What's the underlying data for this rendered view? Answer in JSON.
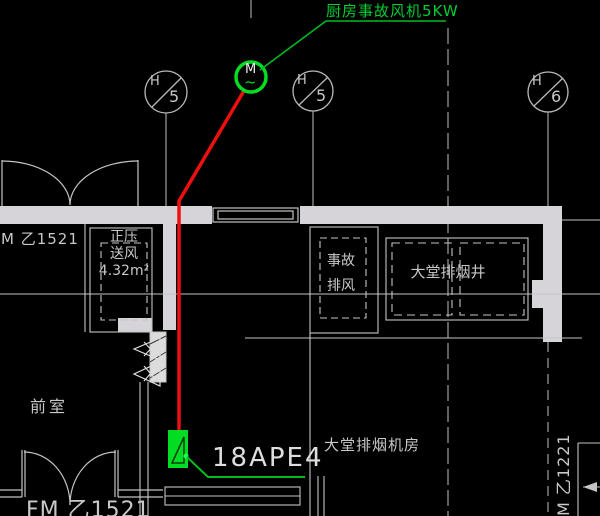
{
  "palette": {
    "background": "#000000",
    "wall_fill": "#d6d4d8",
    "line": "#c4c4c4",
    "green": "#00cc33",
    "bright_green": "#00dd22",
    "red": "#ee1010",
    "text": "#c8c8c8"
  },
  "annotations": {
    "kitchen_fan_note": "厨房事故风机5KW",
    "panel_tag": "18APE4",
    "door_tag_left": "M 乙1521",
    "door_tag_bottom": "FM 乙1521",
    "door_tag_right_vertical": "M 乙1221"
  },
  "motor_symbol": {
    "letter": "M",
    "wave": "~"
  },
  "grid_bubbles": [
    {
      "letter": "H",
      "number": "5"
    },
    {
      "letter": "H",
      "number": "5"
    },
    {
      "letter": "H",
      "number": "6"
    }
  ],
  "rooms": {
    "anteroom": "前室",
    "fan_room": "大堂排烟机房",
    "lobby_smoke_shaft": "大堂排烟井",
    "pressurization_shaft_line1": "正压",
    "pressurization_shaft_line2": "送风",
    "pressurization_shaft_area": "4.32m²",
    "emergency_exhaust_line1": "事故",
    "emergency_exhaust_line2": "排风"
  }
}
